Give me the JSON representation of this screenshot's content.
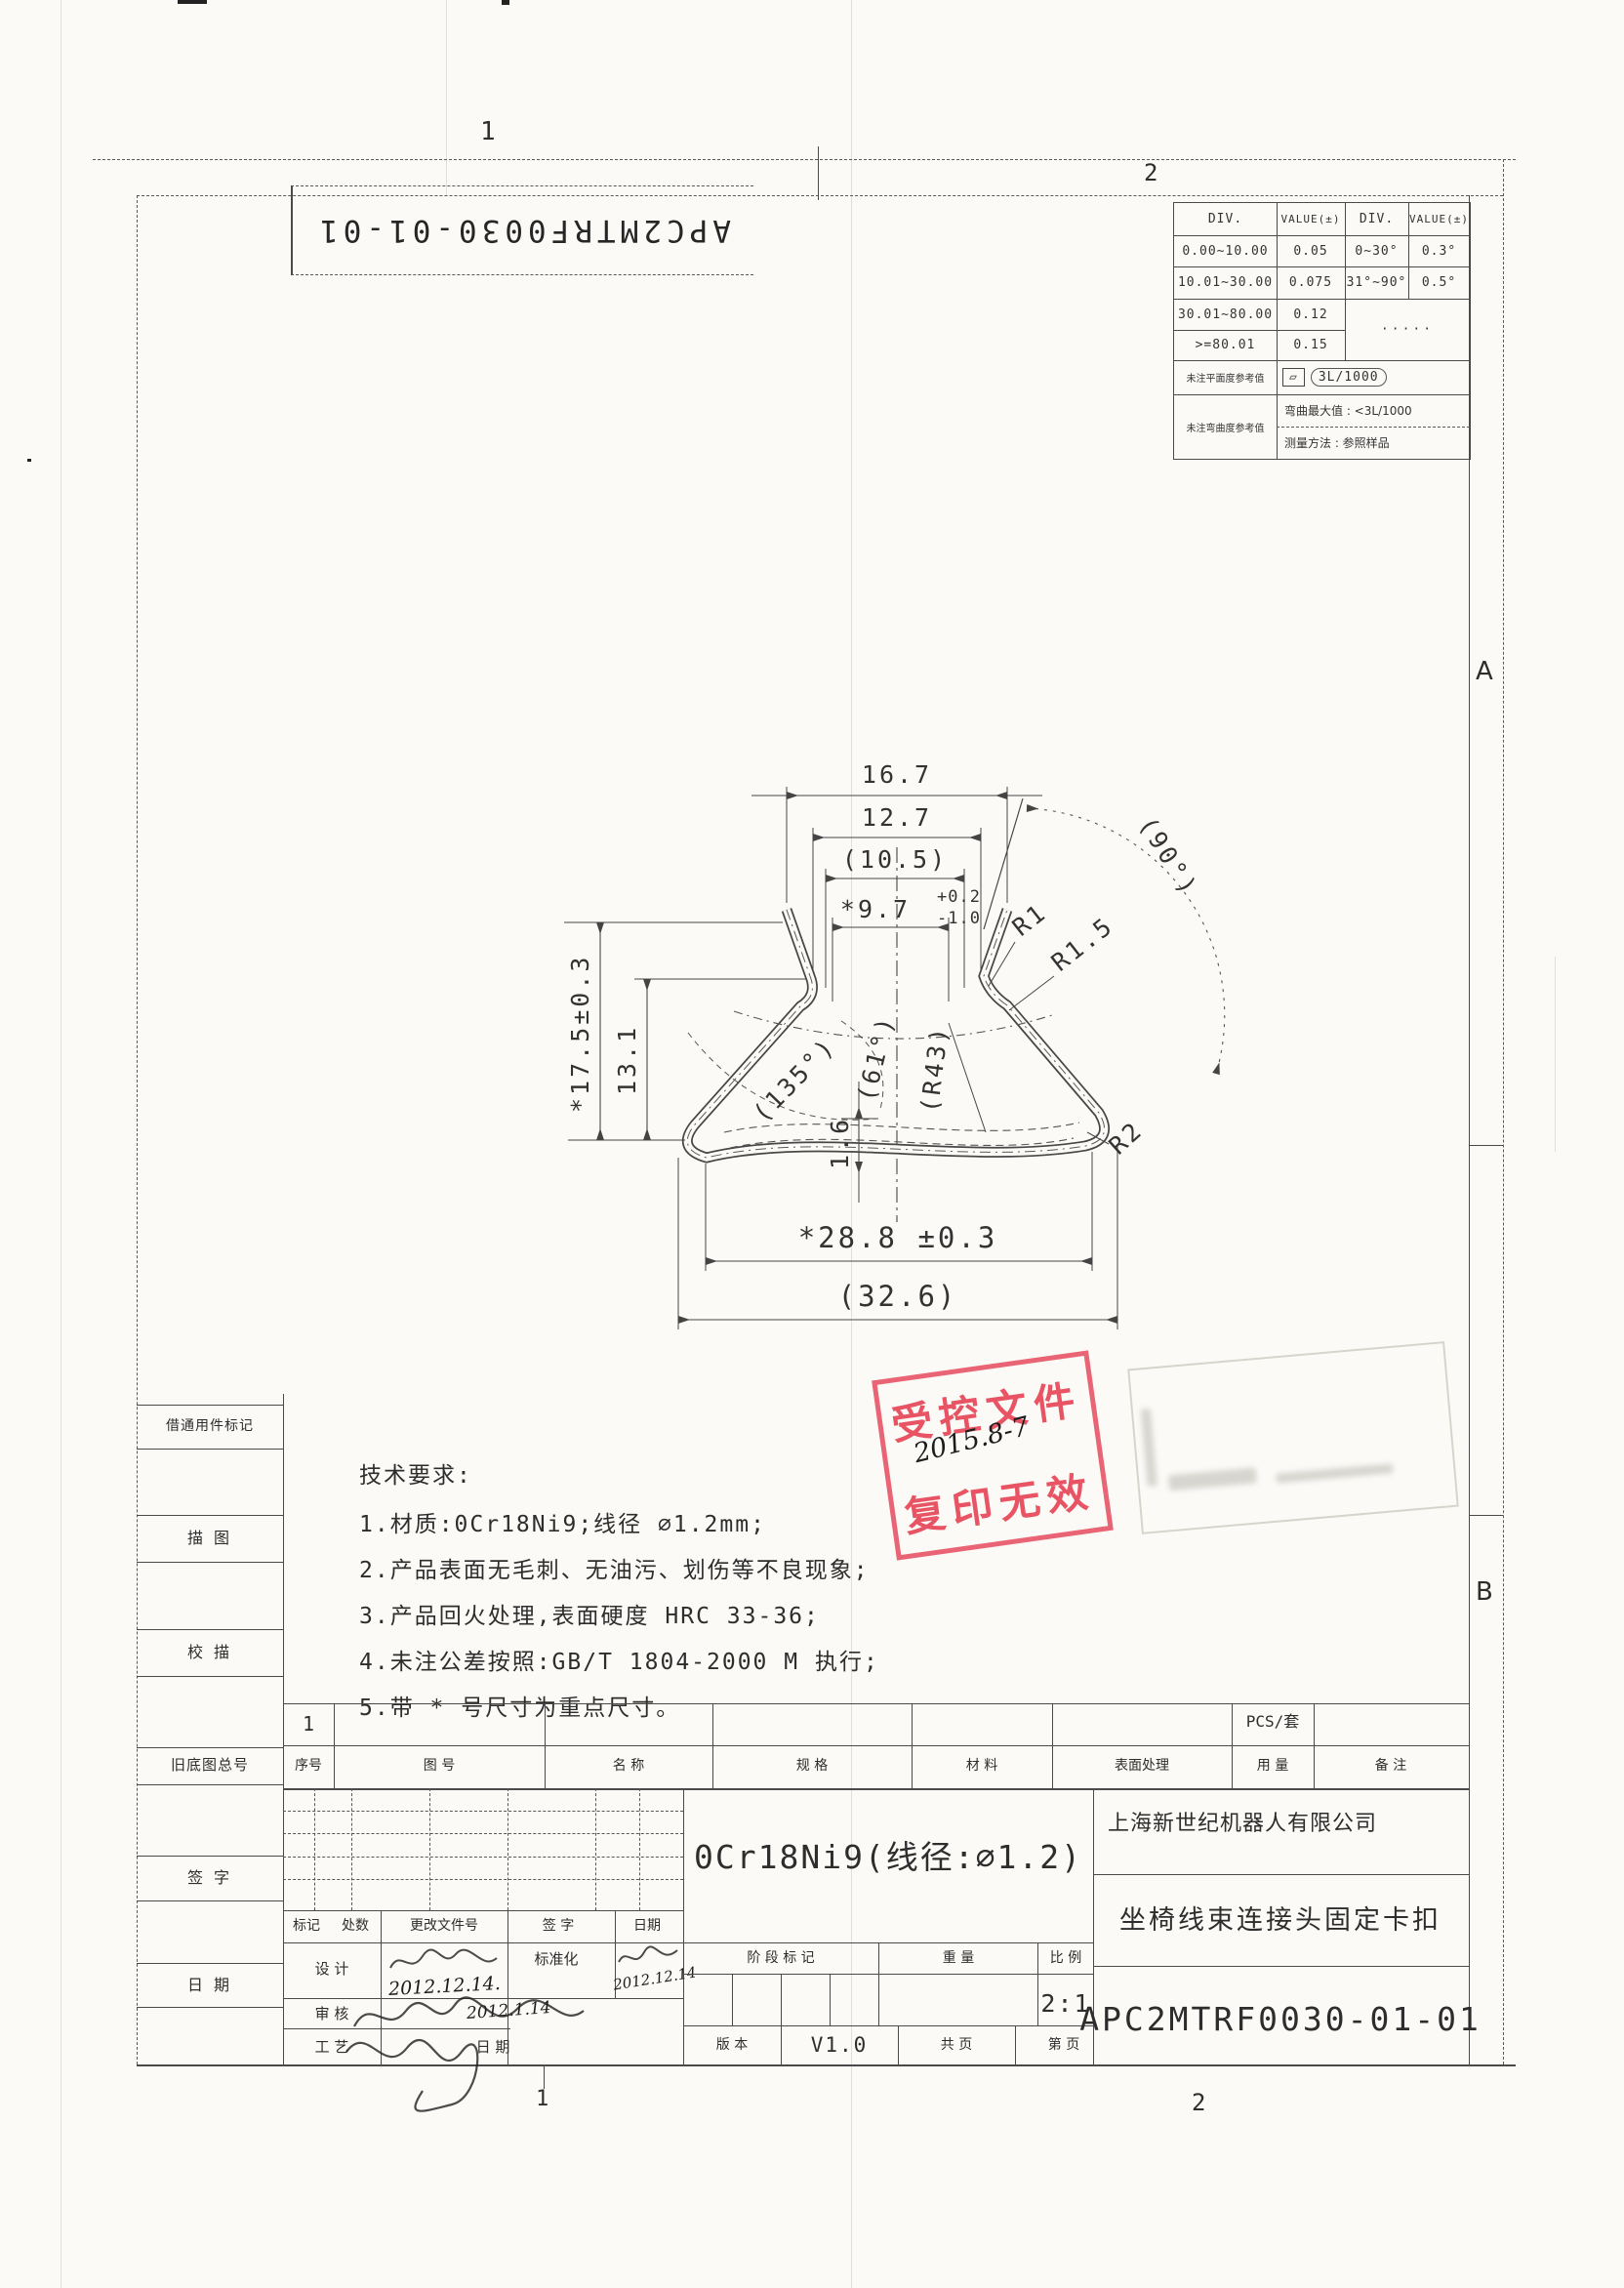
{
  "colors": {
    "stamp_red": "#e53e52",
    "ink": "#3a3a3a"
  },
  "sheet": {
    "doc_number_top_inverted": "APC2MTRF0030-01-01",
    "zones": {
      "top1": "1",
      "top2": "2",
      "bottom1": "1",
      "bottom2": "2",
      "right_a": "A",
      "right_b": "B"
    }
  },
  "tolerance_table": {
    "h1": "DIV.",
    "h2": "VALUE(±)",
    "h3": "DIV.",
    "h4": "VALUE(±)",
    "rows": [
      {
        "c1": "0.00~10.00",
        "c2": "0.05",
        "c3": "0~30°",
        "c4": "0.3°"
      },
      {
        "c1": "10.01~30.00",
        "c2": "0.075",
        "c3": "31°~90°",
        "c4": "0.5°"
      },
      {
        "c1": "30.01~80.00",
        "c2": "0.12",
        "c34": "·····"
      },
      {
        "c1": ">=80.01",
        "c2": "0.15"
      }
    ],
    "flatness_label": "未注平面度参考值",
    "flatness_symbol": "▱",
    "flatness_value": "3L/1000",
    "bend_label": "未注弯曲度参考值",
    "bend_max": "弯曲最大值 : <3L/1000",
    "bend_method": "测量方法 : 参照样品"
  },
  "dims": {
    "w_top": "16.7",
    "w2": "12.7",
    "w3": "(10.5)",
    "w4": "*9.7",
    "w4_tol_up": "+0.2",
    "w4_tol_dn": "-1.0",
    "angle90": "(90°)",
    "r1": "R1",
    "r15": "R1.5",
    "angle135": "(135°)",
    "angle61": "(61°)",
    "r43": "(R43)",
    "r2": "R2",
    "h_total": "*17.5±0.3",
    "h2": "13.1",
    "h3": "1.6",
    "w_bottom": "*28.8 ±0.3",
    "w_overall": "(32.6)"
  },
  "tech_req": {
    "title": "技术要求:",
    "item1": "1.材质:0Cr18Ni9;线径 ∅1.2mm;",
    "item2": "2.产品表面无毛刺、无油污、划伤等不良现象;",
    "item3": "3.产品回火处理,表面硬度 HRC 33-36;",
    "item4": "4.未注公差按照:GB/T 1804-2000 M 执行;",
    "item5": "5.带 * 号尺寸为重点尺寸。"
  },
  "stamp": {
    "line1": "受控文件",
    "line2": "复印无效",
    "handwritten": "2015.8-7"
  },
  "margin": {
    "l1": "借通用件标记",
    "l2": "描 图",
    "l3": "校 描",
    "l4": "旧底图总号",
    "l5": "签 字",
    "l6": "日 期"
  },
  "bom": {
    "item_no": "1",
    "pcs": "PCS/套",
    "h_index": "序号",
    "h_dwg": "图  号",
    "h_name": "名  称",
    "h_spec": "规  格",
    "h_mat": "材  料",
    "h_surf": "表面处理",
    "h_qty": "用 量",
    "h_note": "备  注"
  },
  "tb": {
    "mark": "标记",
    "count": "处数",
    "change_doc": "更改文件号",
    "sign": "签  字",
    "date": "日期",
    "design": "设  计",
    "standardize": "标准化",
    "check": "审  核",
    "process": "工  艺",
    "date2": "日 期",
    "design_date": "2012.12.14.",
    "std_date": "2012.12.14",
    "check_date": "2012.1.14",
    "stage": "阶 段 标 记",
    "weight": "重  量",
    "scale_label": "比  例",
    "scale": "2:1",
    "version_label": "版  本",
    "version": "V1.0",
    "pages_total": "共  页",
    "page_no": "第  页",
    "material": "0Cr18Ni9(线径:∅1.2)",
    "company": "上海新世纪机器人有限公司",
    "part_name": "坐椅线束连接头固定卡扣",
    "drawing_no": "APC2MTRF0030-01-01"
  }
}
